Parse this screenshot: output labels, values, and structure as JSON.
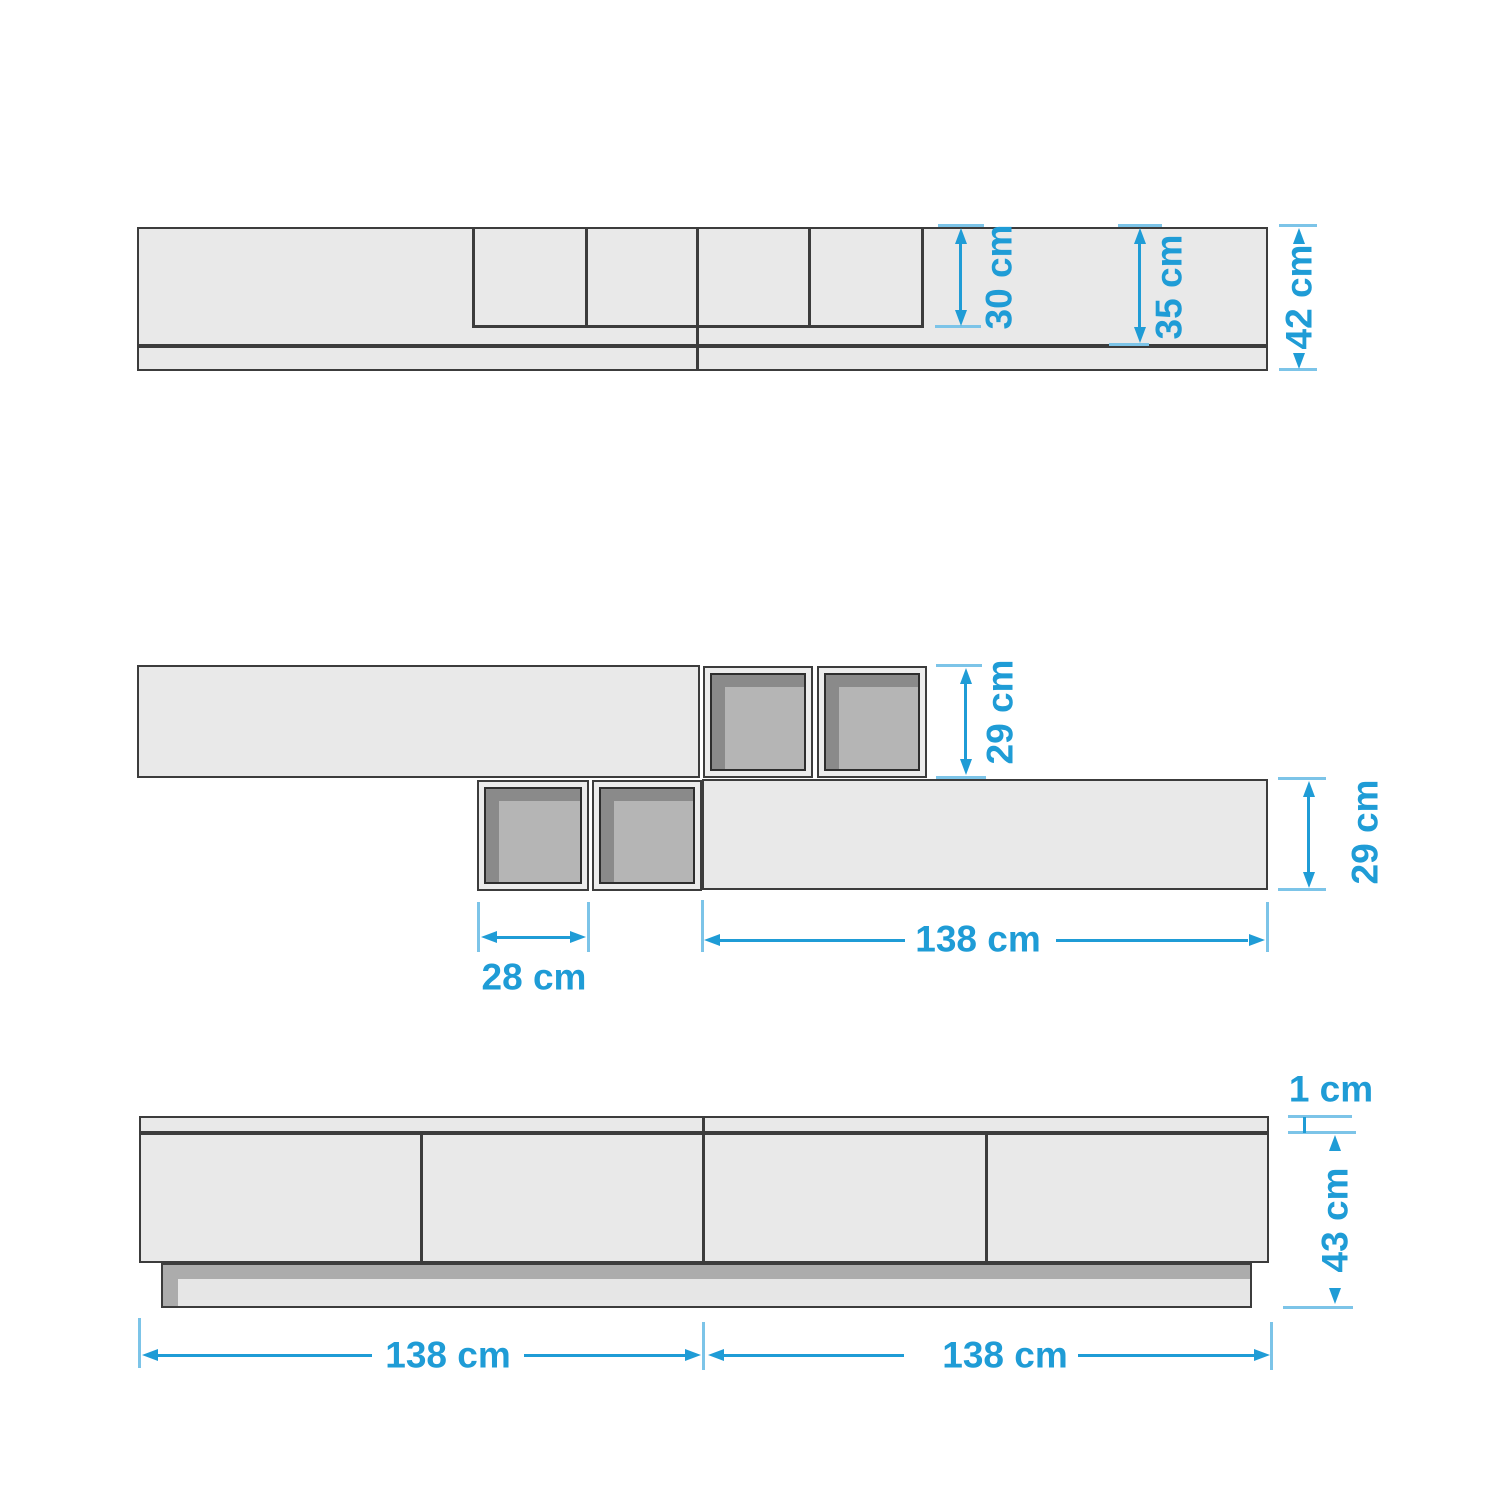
{
  "palette": {
    "dimension_blue": "#1F9CD6",
    "extension_blue": "#7CC4E8",
    "outline_gray": "#3C3C3C",
    "panel_gray": "#E9E9E9",
    "cube_shadow_gray": "#8A8A8A",
    "cube_back_gray": "#B5B5B5",
    "plinth_dark_gray": "#ACACAC",
    "plinth_light_gray": "#E6E6E6"
  },
  "views": {
    "hanging_shelf": {
      "name": "hanging wall shelf front view",
      "dims": {
        "opening_height": "30 cm",
        "carcass_height": "35 cm",
        "total_height": "42 cm"
      }
    },
    "wall_boards": {
      "name": "wall boards with cubes front view",
      "dims": {
        "upper_row_height": "29 cm",
        "lower_row_height": "29 cm",
        "cube_width": "28 cm",
        "board_width": "138 cm"
      }
    },
    "lowboard": {
      "name": "lowboard front view",
      "dims": {
        "top_panel_thickness": "1 cm",
        "body_height": "43 cm",
        "left_unit_width": "138 cm",
        "right_unit_width": "138 cm"
      }
    }
  }
}
